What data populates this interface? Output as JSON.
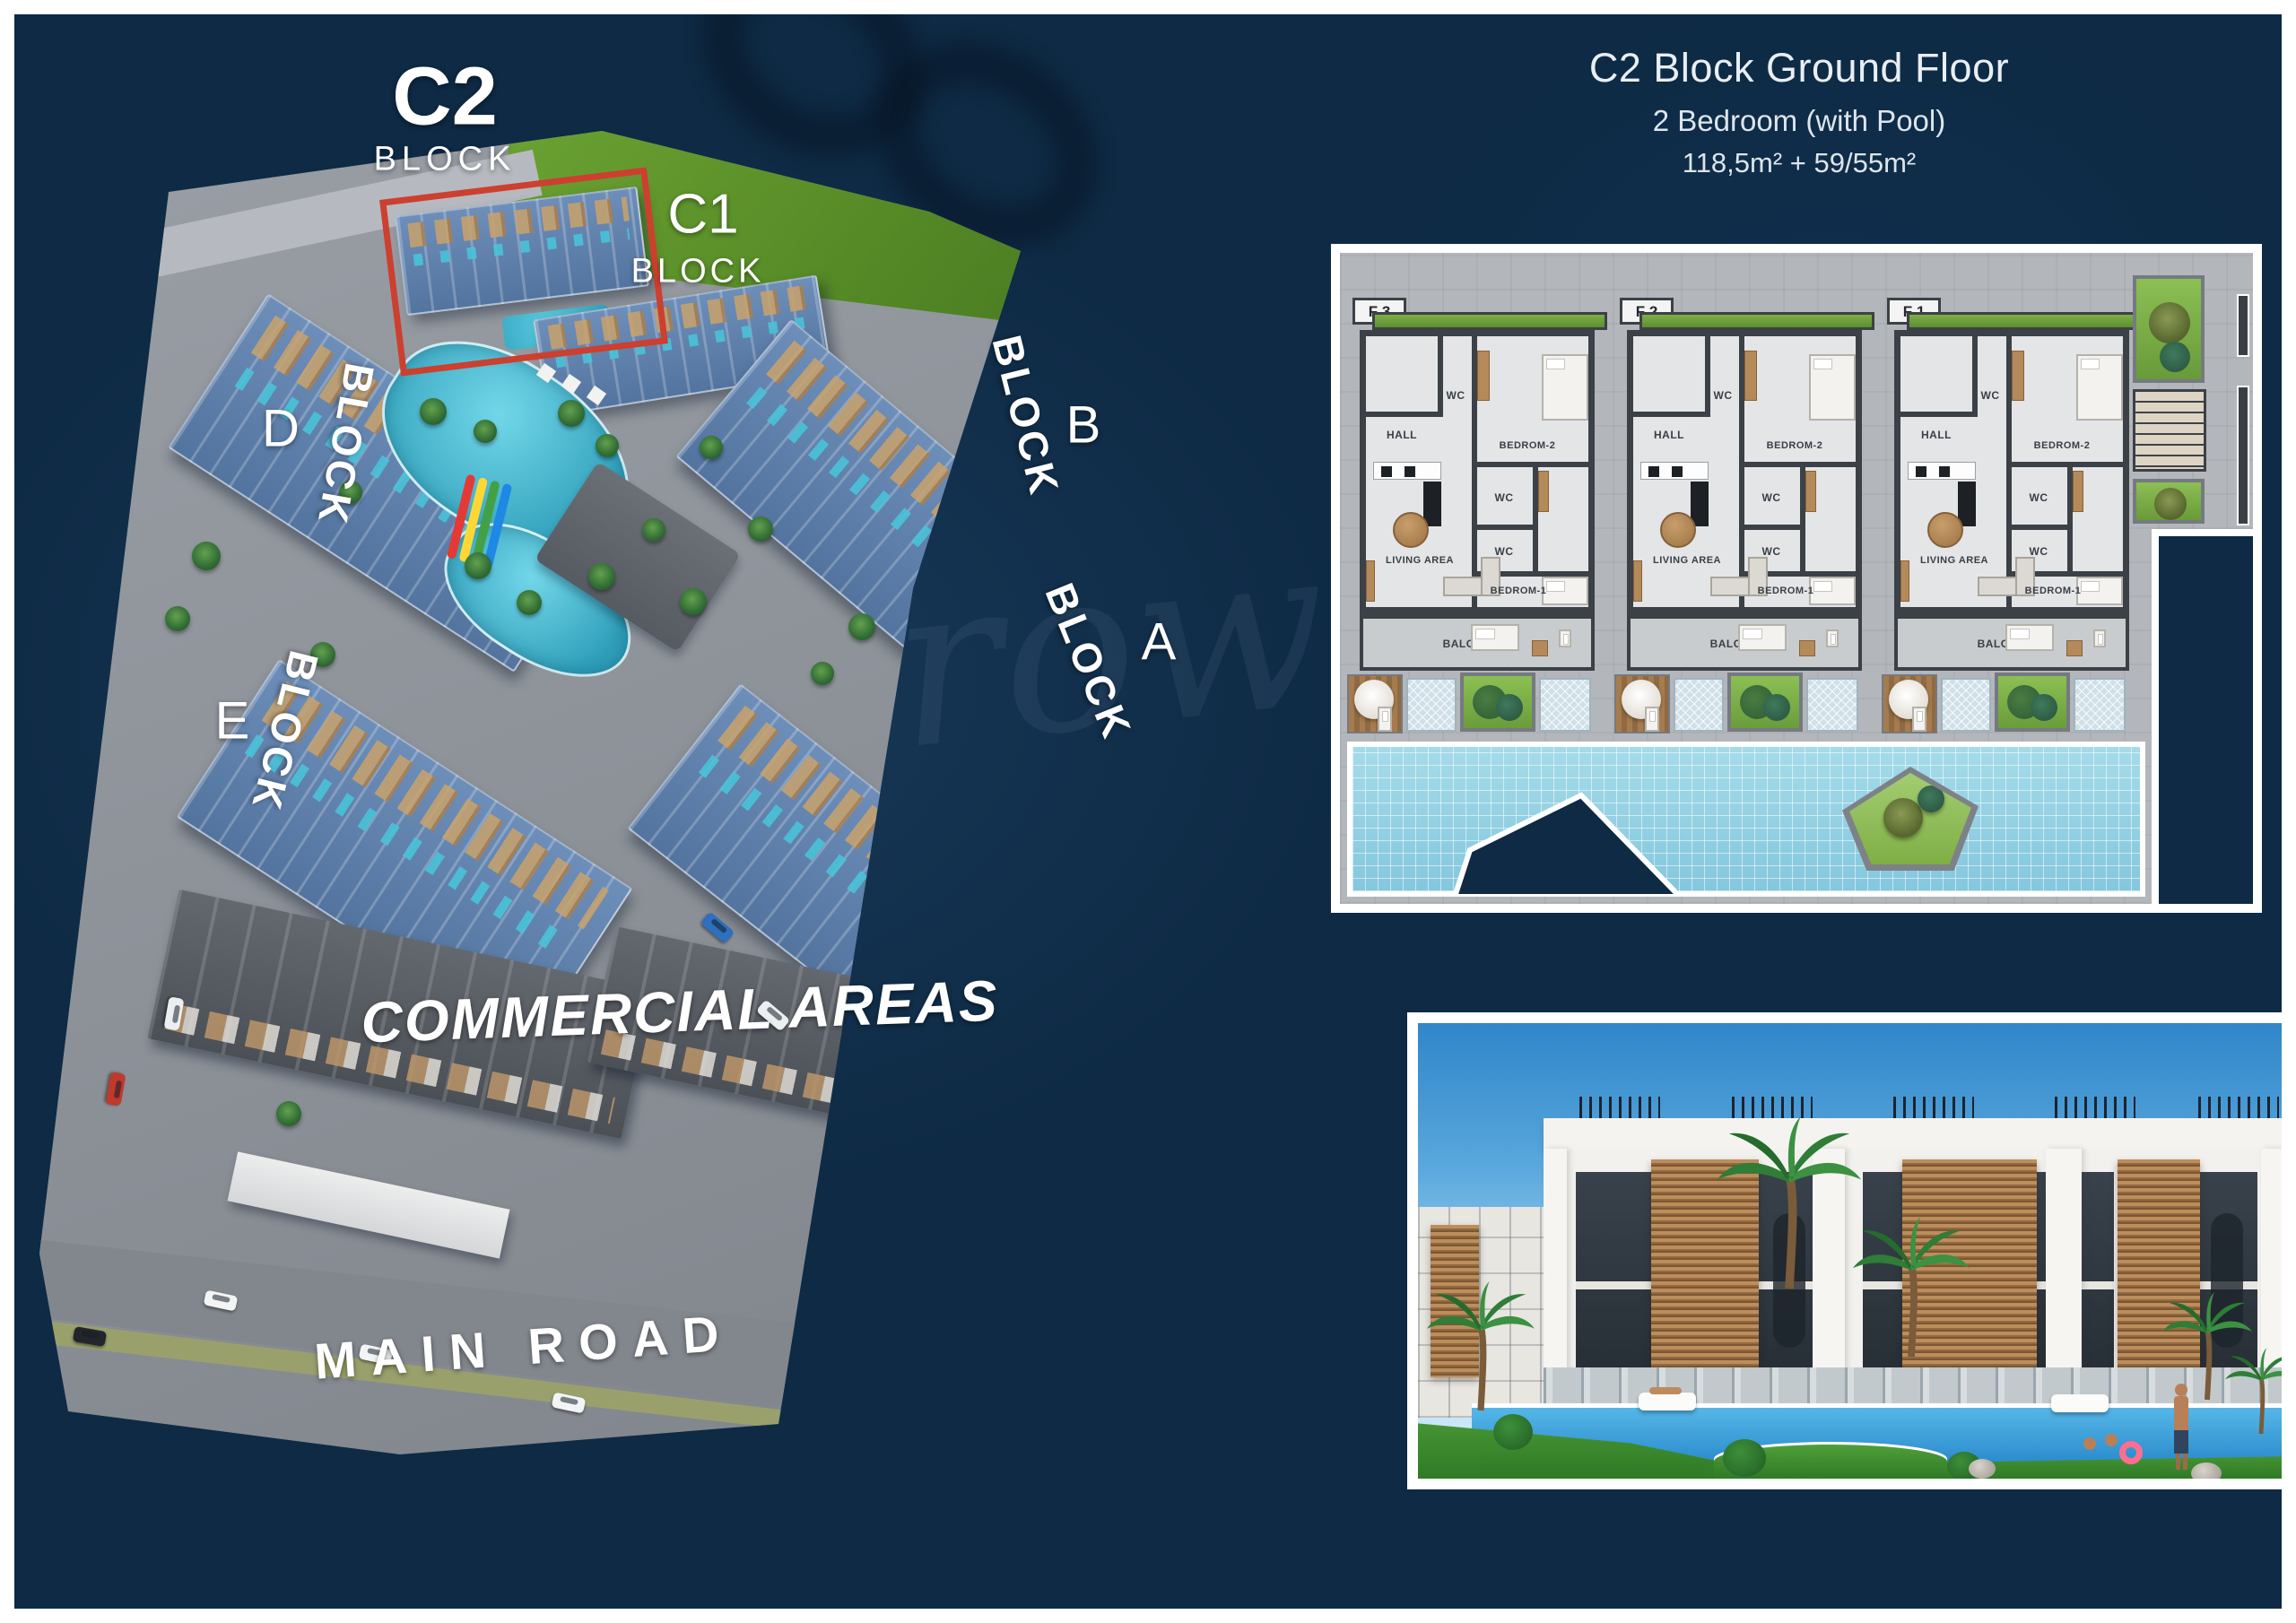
{
  "colors": {
    "navy_background": "#0e2a44",
    "highlight_red": "#cd3f2e",
    "pool_blue": "#8fd0e2",
    "grass_green": "#7fae45",
    "wood_tan": "#c9a26b",
    "wall_dark": "#3c4147",
    "frame_white": "#ffffff"
  },
  "site_plan": {
    "c2": {
      "label": "C2",
      "sub": "BLOCK"
    },
    "c1": {
      "label": "C1",
      "sub": "BLOCK"
    },
    "blocks": [
      {
        "letter": "D",
        "word": "BLOCK"
      },
      {
        "letter": "B",
        "word": "BLOCK"
      },
      {
        "letter": "A",
        "word": "BLOCK"
      },
      {
        "letter": "E",
        "word": "BLOCK"
      }
    ],
    "commercial_label": "COMMERCIAL AREAS",
    "main_road_label": "MAIN ROAD",
    "watermark": "row"
  },
  "floor_plan": {
    "title": "C2 Block Ground Floor",
    "subtitle": "2 Bedroom (with Pool)",
    "area": "118,5m² + 59/55m²",
    "units": [
      {
        "id": "F 3"
      },
      {
        "id": "F 2"
      },
      {
        "id": "F 1"
      }
    ],
    "room_labels": {
      "hall": "HALL",
      "wc": "WC",
      "bedroom2": "BEDROM-2",
      "living": "LIVING AREA",
      "bedroom1": "BEDROM-1",
      "balcony": "BALCONY"
    }
  }
}
